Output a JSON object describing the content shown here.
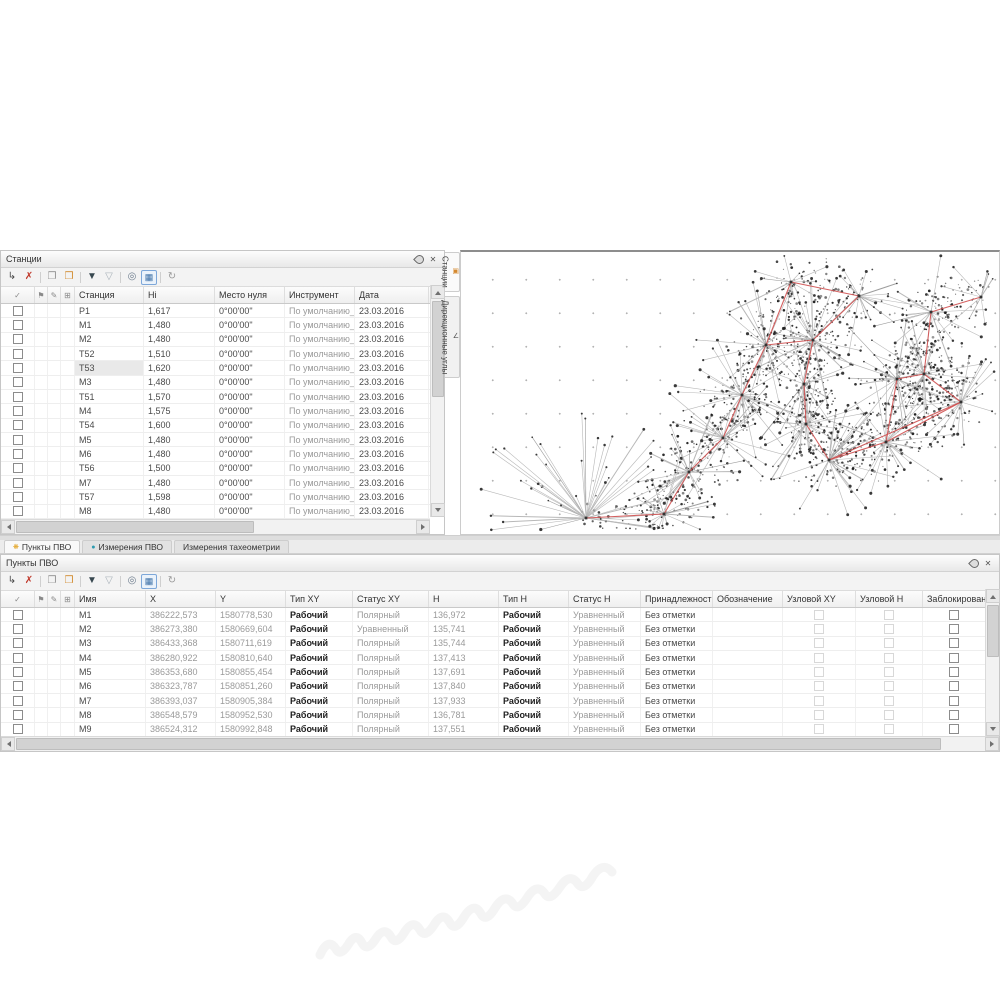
{
  "stations_panel": {
    "title": "Станции",
    "columns": [
      "Станция",
      "Hi",
      "Место нуля",
      "Инструмент",
      "Дата"
    ],
    "selected_row_index": 4,
    "rows": [
      {
        "name": "P1",
        "hi": "1,617",
        "zero": "0°00'00\"",
        "instrument": "По умолчанию_1",
        "date": "23.03.2016"
      },
      {
        "name": "М1",
        "hi": "1,480",
        "zero": "0°00'00\"",
        "instrument": "По умолчанию_1",
        "date": "23.03.2016"
      },
      {
        "name": "М2",
        "hi": "1,480",
        "zero": "0°00'00\"",
        "instrument": "По умолчанию_1",
        "date": "23.03.2016"
      },
      {
        "name": "Т52",
        "hi": "1,510",
        "zero": "0°00'00\"",
        "instrument": "По умолчанию_1",
        "date": "23.03.2016"
      },
      {
        "name": "Т53",
        "hi": "1,620",
        "zero": "0°00'00\"",
        "instrument": "По умолчанию_1",
        "date": "23.03.2016"
      },
      {
        "name": "М3",
        "hi": "1,480",
        "zero": "0°00'00\"",
        "instrument": "По умолчанию_1",
        "date": "23.03.2016"
      },
      {
        "name": "Т51",
        "hi": "1,570",
        "zero": "0°00'00\"",
        "instrument": "По умолчанию_1",
        "date": "23.03.2016"
      },
      {
        "name": "М4",
        "hi": "1,575",
        "zero": "0°00'00\"",
        "instrument": "По умолчанию_1",
        "date": "23.03.2016"
      },
      {
        "name": "Т54",
        "hi": "1,600",
        "zero": "0°00'00\"",
        "instrument": "По умолчанию_1",
        "date": "23.03.2016"
      },
      {
        "name": "М5",
        "hi": "1,480",
        "zero": "0°00'00\"",
        "instrument": "По умолчанию_1",
        "date": "23.03.2016"
      },
      {
        "name": "М6",
        "hi": "1,480",
        "zero": "0°00'00\"",
        "instrument": "По умолчанию_1",
        "date": "23.03.2016"
      },
      {
        "name": "Т56",
        "hi": "1,500",
        "zero": "0°00'00\"",
        "instrument": "По умолчанию_1",
        "date": "23.03.2016"
      },
      {
        "name": "М7",
        "hi": "1,480",
        "zero": "0°00'00\"",
        "instrument": "По умолчанию_1",
        "date": "23.03.2016"
      },
      {
        "name": "Т57",
        "hi": "1,598",
        "zero": "0°00'00\"",
        "instrument": "По умолчанию_1",
        "date": "23.03.2016"
      },
      {
        "name": "М8",
        "hi": "1,480",
        "zero": "0°00'00\"",
        "instrument": "По умолчанию_1",
        "date": "23.03.2016"
      }
    ]
  },
  "points_panel": {
    "title": "Пункты ПВО",
    "columns": [
      "Имя",
      "X",
      "Y",
      "Тип XY",
      "Статус XY",
      "H",
      "Тип H",
      "Статус H",
      "Принадлежность",
      "Обозначение",
      "Узловой XY",
      "Узловой H",
      "Заблокирован"
    ],
    "rows": [
      {
        "name": "М1",
        "x": "386222,573",
        "y": "1580778,530",
        "type_xy": "Рабочий",
        "status_xy": "Полярный",
        "h": "136,972",
        "type_h": "Рабочий",
        "status_h": "Уравненный",
        "membership": "Без отметки",
        "designation": ""
      },
      {
        "name": "М2",
        "x": "386273,380",
        "y": "1580669,604",
        "type_xy": "Рабочий",
        "status_xy": "Уравненный",
        "h": "135,741",
        "type_h": "Рабочий",
        "status_h": "Уравненный",
        "membership": "Без отметки",
        "designation": ""
      },
      {
        "name": "М3",
        "x": "386433,368",
        "y": "1580711,619",
        "type_xy": "Рабочий",
        "status_xy": "Полярный",
        "h": "135,744",
        "type_h": "Рабочий",
        "status_h": "Уравненный",
        "membership": "Без отметки",
        "designation": ""
      },
      {
        "name": "М4",
        "x": "386280,922",
        "y": "1580810,640",
        "type_xy": "Рабочий",
        "status_xy": "Полярный",
        "h": "137,413",
        "type_h": "Рабочий",
        "status_h": "Уравненный",
        "membership": "Без отметки",
        "designation": ""
      },
      {
        "name": "М5",
        "x": "386353,680",
        "y": "1580855,454",
        "type_xy": "Рабочий",
        "status_xy": "Полярный",
        "h": "137,691",
        "type_h": "Рабочий",
        "status_h": "Уравненный",
        "membership": "Без отметки",
        "designation": ""
      },
      {
        "name": "М6",
        "x": "386323,787",
        "y": "1580851,260",
        "type_xy": "Рабочий",
        "status_xy": "Полярный",
        "h": "137,840",
        "type_h": "Рабочий",
        "status_h": "Уравненный",
        "membership": "Без отметки",
        "designation": ""
      },
      {
        "name": "М7",
        "x": "386393,037",
        "y": "1580905,384",
        "type_xy": "Рабочий",
        "status_xy": "Полярный",
        "h": "137,933",
        "type_h": "Рабочий",
        "status_h": "Уравненный",
        "membership": "Без отметки",
        "designation": ""
      },
      {
        "name": "М8",
        "x": "386548,579",
        "y": "1580952,530",
        "type_xy": "Рабочий",
        "status_xy": "Полярный",
        "h": "136,781",
        "type_h": "Рабочий",
        "status_h": "Уравненный",
        "membership": "Без отметки",
        "designation": ""
      },
      {
        "name": "М9",
        "x": "386524,312",
        "y": "1580992,848",
        "type_xy": "Рабочий",
        "status_xy": "Полярный",
        "h": "137,551",
        "type_h": "Рабочий",
        "status_h": "Уравненный",
        "membership": "Без отметки",
        "designation": ""
      }
    ]
  },
  "toolbar_icons": [
    {
      "name": "add-node-icon",
      "glyph": "↳",
      "color": "#4a4a4a"
    },
    {
      "name": "delete-icon",
      "glyph": "✗",
      "color": "#c0392b"
    },
    {
      "name": "sep1",
      "sep": true
    },
    {
      "name": "copy-icon",
      "glyph": "❐",
      "color": "#8f8f8f"
    },
    {
      "name": "paste-icon",
      "glyph": "❒",
      "color": "#d1892a"
    },
    {
      "name": "sep2",
      "sep": true
    },
    {
      "name": "filter-on-icon",
      "glyph": "▼",
      "color": "#37474f"
    },
    {
      "name": "filter-off-icon",
      "glyph": "▽",
      "color": "#a7b0b8"
    },
    {
      "name": "sep3",
      "sep": true
    },
    {
      "name": "search-icon",
      "glyph": "◎",
      "color": "#6b7b8c"
    },
    {
      "name": "table-settings-icon",
      "glyph": "▦",
      "color": "#3a6ea5",
      "boxed": true
    },
    {
      "name": "sep4",
      "sep": true
    },
    {
      "name": "refresh-icon",
      "glyph": "↻",
      "color": "#9a9a9a"
    }
  ],
  "header_icons": {
    "check": "✓",
    "flag": "⚑",
    "pencil": "✎",
    "grid": "⊞"
  },
  "window_icons": {
    "close": "✕"
  },
  "side_tabs": [
    {
      "label": "Станции",
      "icon_glyph": "▣",
      "icon_color": "#d4882e",
      "active": true
    },
    {
      "label": "Дирекционные углы",
      "icon_glyph": "∠",
      "icon_color": "#555555",
      "active": false
    }
  ],
  "bottom_tabs": [
    {
      "label": "Пункты ПВО",
      "icon_glyph": "❋",
      "icon_color": "#e09c10",
      "active": true
    },
    {
      "label": "Измерения ПВО",
      "icon_glyph": "●",
      "icon_color": "#2e9bb0",
      "active": false
    },
    {
      "label": "Измерения тахеометрии",
      "icon_glyph": "",
      "icon_color": "",
      "active": false
    }
  ],
  "map": {
    "accent_color": "#cf5050",
    "ray_color": "#b8b8b8",
    "dot_color": "#1a1a1a",
    "hubs": [
      [
        125,
        266
      ],
      [
        203,
        262
      ],
      [
        228,
        220
      ],
      [
        262,
        186
      ],
      [
        281,
        143
      ],
      [
        305,
        93
      ],
      [
        352,
        88
      ],
      [
        343,
        132
      ],
      [
        345,
        172
      ],
      [
        368,
        208
      ],
      [
        425,
        190
      ],
      [
        436,
        127
      ],
      [
        463,
        122
      ],
      [
        500,
        150
      ],
      [
        330,
        30
      ],
      [
        398,
        44
      ],
      [
        470,
        60
      ],
      [
        520,
        45
      ]
    ],
    "chain": [
      [
        0,
        1
      ],
      [
        1,
        2
      ],
      [
        2,
        3
      ],
      [
        3,
        4
      ],
      [
        4,
        5
      ],
      [
        5,
        6
      ],
      [
        6,
        7
      ],
      [
        7,
        8
      ],
      [
        8,
        9
      ],
      [
        9,
        10
      ],
      [
        10,
        11
      ],
      [
        11,
        12
      ],
      [
        12,
        16
      ],
      [
        9,
        13
      ],
      [
        13,
        12
      ],
      [
        5,
        14
      ],
      [
        14,
        15
      ],
      [
        15,
        6
      ],
      [
        16,
        17
      ],
      [
        13,
        10
      ]
    ],
    "hub_ray_counts": [
      58,
      26,
      30,
      24,
      34,
      28,
      30,
      22,
      26,
      32,
      30,
      24,
      22,
      26,
      20,
      22,
      18,
      16
    ]
  }
}
